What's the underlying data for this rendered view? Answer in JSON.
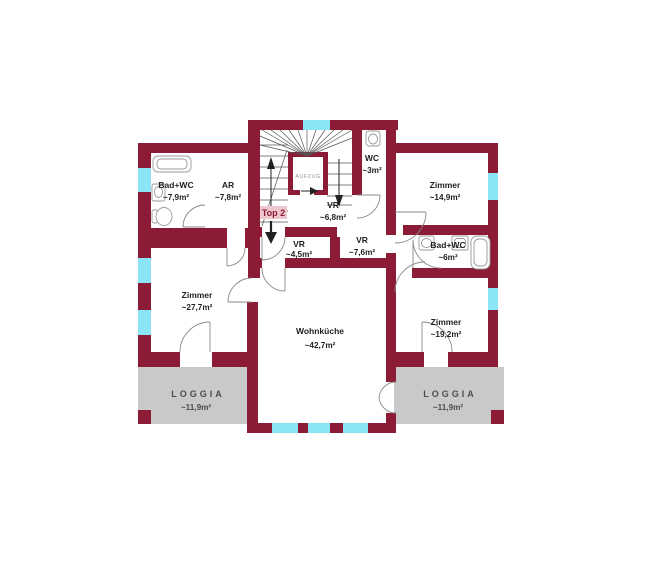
{
  "plan": {
    "unit": {
      "label": "Top 2"
    },
    "elevator": {
      "label": "AUFZUG"
    },
    "rooms": [
      {
        "id": "bad-wc-left",
        "name": "Bad+WC",
        "area": "~7,9m²"
      },
      {
        "id": "ar",
        "name": "AR",
        "area": "~7,8m²"
      },
      {
        "id": "wc",
        "name": "WC",
        "area": "~3m²"
      },
      {
        "id": "zimmer-top-right",
        "name": "Zimmer",
        "area": "~14,9m²"
      },
      {
        "id": "vr-center",
        "name": "VR",
        "area": "~6,8m²"
      },
      {
        "id": "vr-small",
        "name": "VR",
        "area": "~4,5m²"
      },
      {
        "id": "vr-right",
        "name": "VR",
        "area": "~7,6m²"
      },
      {
        "id": "bad-wc-right",
        "name": "Bad+WC",
        "area": "~6m²"
      },
      {
        "id": "zimmer-left",
        "name": "Zimmer",
        "area": "~27,7m²"
      },
      {
        "id": "wohnkueche",
        "name": "Wohnküche",
        "area": "~42,7m²"
      },
      {
        "id": "zimmer-bottom-right",
        "name": "Zimmer",
        "area": "~19,2m²"
      },
      {
        "id": "loggia-left",
        "name": "LOGGIA",
        "area": "~11,9m²"
      },
      {
        "id": "loggia-right",
        "name": "LOGGIA",
        "area": "~11,9m²"
      }
    ],
    "colors": {
      "wall": "#8C1B36",
      "window": "#8BE5F6",
      "loggia": "#C9C9C9",
      "badge_bg": "#EFC7CE",
      "badge_text": "#8C1B36",
      "door": "#8A8A8A",
      "stair": "#555555",
      "arrow": "#222222",
      "fixture": "#9A9A9A",
      "text": "#1F1F1F",
      "loggia_text": "#4D4D4D",
      "elevator_text": "#9A9A9A"
    }
  }
}
